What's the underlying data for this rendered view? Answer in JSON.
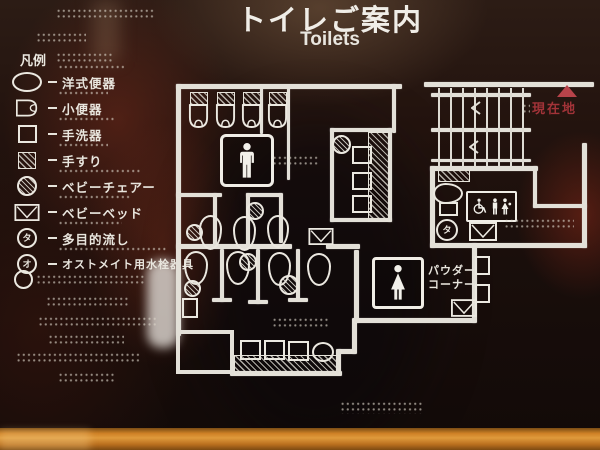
{
  "title": {
    "ja": "トイレご案内",
    "en": "Toilets"
  },
  "legend": {
    "heading": "凡例",
    "items": [
      {
        "icon": "western-toilet-icon",
        "label": "洋式便器"
      },
      {
        "icon": "urinal-icon",
        "label": "小便器"
      },
      {
        "icon": "washbasin-icon",
        "label": "手洗器"
      },
      {
        "icon": "handrail-icon",
        "label": "手すり"
      },
      {
        "icon": "baby-chair-icon",
        "label": "ベビーチェアー"
      },
      {
        "icon": "baby-bed-icon",
        "label": "ベビーベッド"
      },
      {
        "icon": "multipurpose-sink-icon",
        "label": "多目的流し",
        "glyph": "タ"
      },
      {
        "icon": "ostomate-icon",
        "label": "オストメイト用水栓器具",
        "glyph": "オ"
      }
    ]
  },
  "map": {
    "current_location": "現在地",
    "powder_corner": {
      "line1": "パウダー",
      "line2": "コーナー"
    }
  },
  "colors": {
    "plan_line": "#e8e5dd",
    "current_location_red": "#a23338",
    "frame_orange": "#cf8126",
    "panel_dark": "#16100d"
  }
}
